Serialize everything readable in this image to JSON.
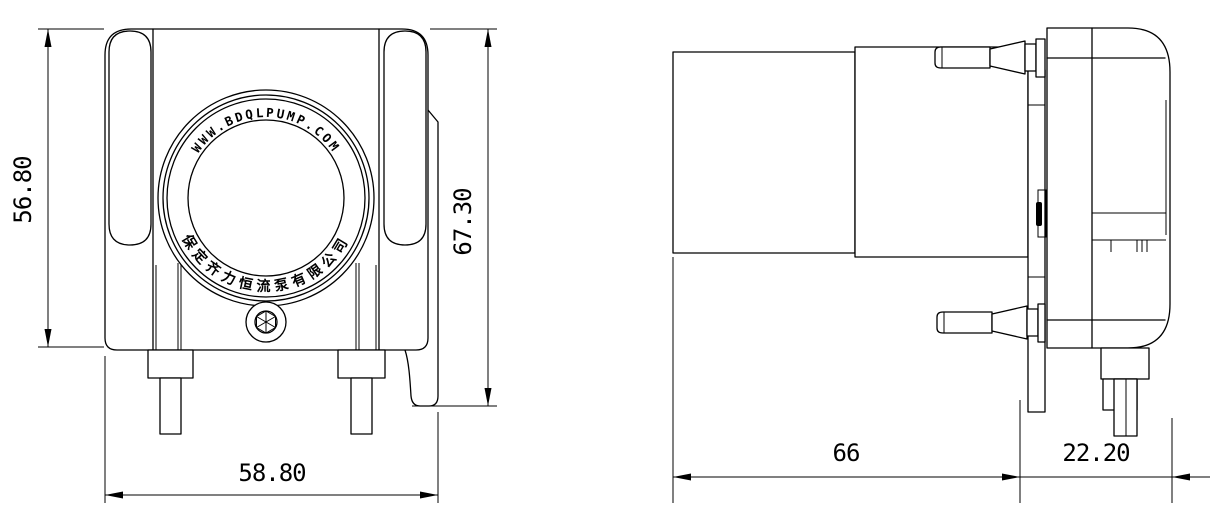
{
  "drawing": {
    "brand": {
      "website": "WWW.BDQLPUMP.COM",
      "company": "保定齐力恒流泵有限公司"
    },
    "front_view": {
      "height_label": "56.80",
      "total_height_label": "67.30",
      "width_label": "58.80"
    },
    "side_view": {
      "body_length_label": "66",
      "head_depth_label": "22.20"
    }
  }
}
